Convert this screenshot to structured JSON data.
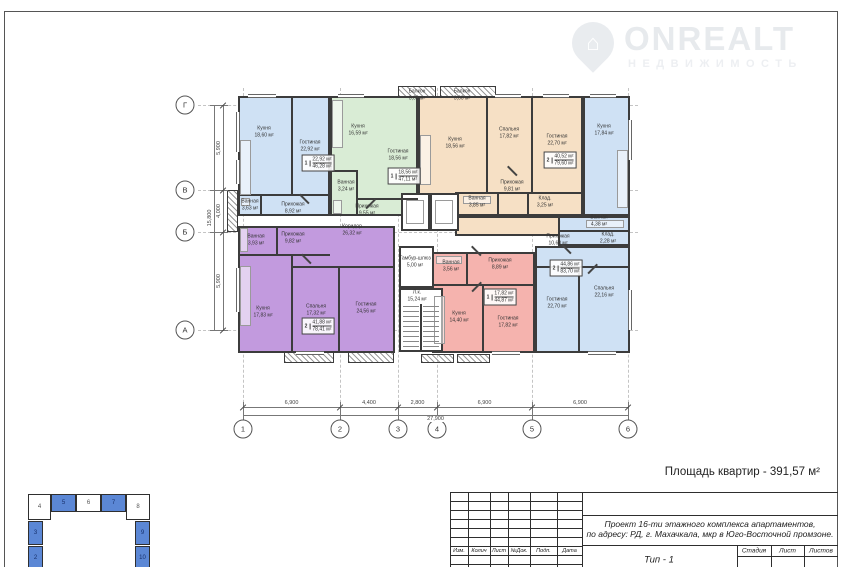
{
  "logo": {
    "brand": "ONREALT",
    "tagline": "НЕДВИЖИМОСТЬ",
    "accent_color": "#e9ecef"
  },
  "note": {
    "apartments_area": "Площадь квартир - 391,57 м²"
  },
  "axes": {
    "columns": [
      {
        "id": "1",
        "x": 243
      },
      {
        "id": "2",
        "x": 340
      },
      {
        "id": "3",
        "x": 398
      },
      {
        "id": "4",
        "x": 437
      },
      {
        "id": "5",
        "x": 532
      },
      {
        "id": "6",
        "x": 628
      }
    ],
    "rows": [
      {
        "id": "Г",
        "y": 105
      },
      {
        "id": "В",
        "y": 190
      },
      {
        "id": "Б",
        "y": 232
      },
      {
        "id": "А",
        "y": 330
      }
    ],
    "col_dims": [
      "6,900",
      "4,400",
      "2,800",
      "6,900",
      "6,900"
    ],
    "col_total": "27,900",
    "row_dims": [
      "5,900",
      "4,000",
      "5,900"
    ],
    "row_total": "15,800"
  },
  "apartments": [
    {
      "color": "#cfe1f4",
      "stamp": {
        "num": "1",
        "live": "22,92 м²",
        "total": "46,28 м²",
        "x": 318,
        "y": 163
      }
    },
    {
      "color": "#d9ecd5",
      "stamp": {
        "num": "1",
        "live": "18,56 м²",
        "total": "47,11 м²",
        "x": 404,
        "y": 176
      }
    },
    {
      "color": "#f6e0c5",
      "stamp": {
        "num": "2",
        "live": "40,52 м²",
        "total": "79,60 м²",
        "x": 560,
        "y": 160
      }
    },
    {
      "color": "#cfe1f4",
      "stamp": {
        "num": "2",
        "live": "44,86 м²",
        "total": "83,70 м²",
        "x": 566,
        "y": 268
      }
    },
    {
      "color": "#c29ade",
      "stamp": {
        "num": "2",
        "live": "41,88 м²",
        "total": "78,41 м²",
        "x": 318,
        "y": 326
      }
    },
    {
      "color": "#f5b3ae",
      "stamp": {
        "num": "1",
        "live": "17,82 м²",
        "total": "44,87 м²",
        "x": 500,
        "y": 297
      }
    }
  ],
  "rooms": [
    {
      "name": "Кухня",
      "area": "18,60 м²",
      "x": 264,
      "y": 132
    },
    {
      "name": "Гостиная",
      "area": "22,92 м²",
      "x": 310,
      "y": 146
    },
    {
      "name": "Ванная",
      "area": "3,63 м²",
      "x": 250,
      "y": 205
    },
    {
      "name": "Прихожая",
      "area": "8,92 м²",
      "x": 293,
      "y": 208
    },
    {
      "name": "Кухня",
      "area": "16,59 м²",
      "x": 358,
      "y": 130
    },
    {
      "name": "Гостиная",
      "area": "18,56 м²",
      "x": 398,
      "y": 155
    },
    {
      "name": "Ванная",
      "area": "3,24 м²",
      "x": 346,
      "y": 186
    },
    {
      "name": "Прихожая",
      "area": "9,55 м²",
      "x": 367,
      "y": 210
    },
    {
      "name": "Балкон",
      "area": "3,60 м²",
      "x": 417,
      "y": 95
    },
    {
      "name": "Балкон",
      "area": "3,60 м²",
      "x": 462,
      "y": 95
    },
    {
      "name": "Кухня",
      "area": "18,56 м²",
      "x": 455,
      "y": 143
    },
    {
      "name": "Спальня",
      "area": "17,82 м²",
      "x": 509,
      "y": 133
    },
    {
      "name": "Гостиная",
      "area": "22,70 м²",
      "x": 557,
      "y": 140
    },
    {
      "name": "Прихожая",
      "area": "9,81 м²",
      "x": 512,
      "y": 186
    },
    {
      "name": "Ванная",
      "area": "3,85 м²",
      "x": 477,
      "y": 202
    },
    {
      "name": "Клад.",
      "area": "3,25 м²",
      "x": 545,
      "y": 202
    },
    {
      "name": "Кухня",
      "area": "17,84 м²",
      "x": 604,
      "y": 130
    },
    {
      "name": "Ванная",
      "area": "4,38 м²",
      "x": 599,
      "y": 221
    },
    {
      "name": "Клад.",
      "area": "2,28 м²",
      "x": 608,
      "y": 238
    },
    {
      "name": "Прихожая",
      "area": "10,68 м²",
      "x": 558,
      "y": 240
    },
    {
      "name": "Гостиная",
      "area": "22,70 м²",
      "x": 557,
      "y": 303
    },
    {
      "name": "Спальня",
      "area": "22,16 м²",
      "x": 604,
      "y": 292
    },
    {
      "name": "Ванная",
      "area": "3,93 м²",
      "x": 256,
      "y": 240
    },
    {
      "name": "Прихожая",
      "area": "9,82 м²",
      "x": 293,
      "y": 238
    },
    {
      "name": "Кухня",
      "area": "17,83 м²",
      "x": 263,
      "y": 312
    },
    {
      "name": "Спальня",
      "area": "17,32 м²",
      "x": 316,
      "y": 310
    },
    {
      "name": "Гостиная",
      "area": "24,56 м²",
      "x": 366,
      "y": 308
    },
    {
      "name": "Ванная",
      "area": "3,56 м²",
      "x": 451,
      "y": 266
    },
    {
      "name": "Прихожая",
      "area": "8,89 м²",
      "x": 500,
      "y": 264
    },
    {
      "name": "Кухня",
      "area": "14,40 м²",
      "x": 459,
      "y": 317
    },
    {
      "name": "Гостиная",
      "area": "17,82 м²",
      "x": 508,
      "y": 322
    },
    {
      "name": "Коридор",
      "area": "26,32 м²",
      "x": 352,
      "y": 230
    },
    {
      "name": "Тамбур-шлюз",
      "area": "5,00 м²",
      "x": 415,
      "y": 262
    },
    {
      "name": "Л.к.",
      "area": "15,24 м²",
      "x": 417,
      "y": 296
    }
  ],
  "key_plan": {
    "fill_color": "#5b87d5",
    "cells": [
      {
        "n": "4",
        "x": 28,
        "y": 494,
        "w": 23,
        "h": 26,
        "filled": false
      },
      {
        "n": "5",
        "x": 51,
        "y": 494,
        "w": 25,
        "h": 18,
        "filled": true
      },
      {
        "n": "6",
        "x": 76,
        "y": 494,
        "w": 25,
        "h": 18,
        "filled": false
      },
      {
        "n": "7",
        "x": 101,
        "y": 494,
        "w": 25,
        "h": 18,
        "filled": true
      },
      {
        "n": "8",
        "x": 126,
        "y": 494,
        "w": 24,
        "h": 26,
        "filled": false
      },
      {
        "n": "3",
        "x": 28,
        "y": 521,
        "w": 15,
        "h": 24,
        "filled": true
      },
      {
        "n": "2",
        "x": 28,
        "y": 546,
        "w": 15,
        "h": 24,
        "filled": true
      },
      {
        "n": "9",
        "x": 135,
        "y": 521,
        "w": 15,
        "h": 24,
        "filled": true
      },
      {
        "n": "10",
        "x": 135,
        "y": 546,
        "w": 15,
        "h": 24,
        "filled": true
      }
    ]
  },
  "title_block": {
    "project_line1": "Проект 16-ти этажного комплекса апартаментов,",
    "project_line2": "по адресу: РД, г. Махачкала, мкр в Юго-Восточной промзоне.",
    "revision_cols": [
      "Изм.",
      "Колич",
      "Лист",
      "№Док.",
      "Подп.",
      "Дата"
    ],
    "stage_cols": [
      "Стадия",
      "Лист",
      "Листов"
    ],
    "type_label": "Тип - 1"
  }
}
